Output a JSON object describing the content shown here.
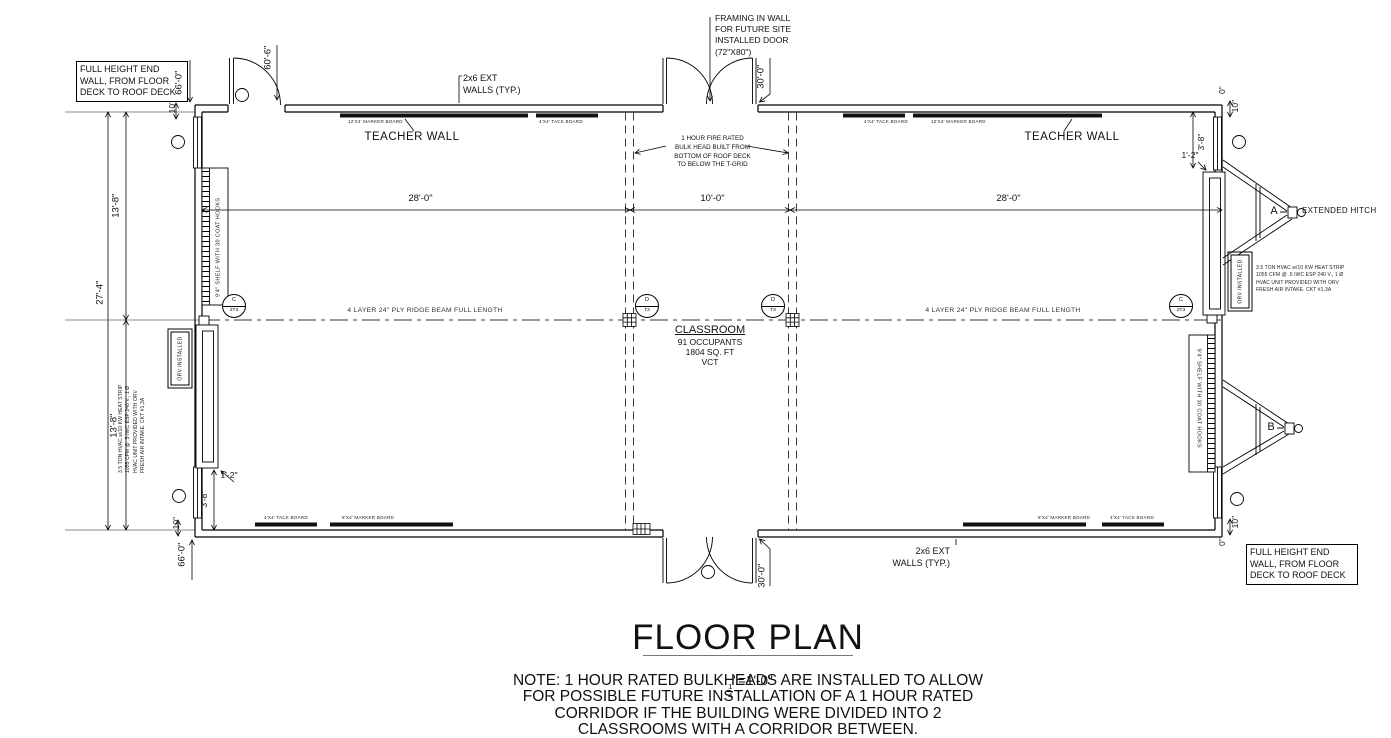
{
  "drawing": {
    "notes": {
      "end_wall": "FULL HEIGHT END\nWALL, FROM FLOOR\nDECK TO ROOF DECK",
      "framing": "FRAMING IN WALL\nFOR FUTURE SITE\nINSTALLED DOOR\n(72\"X80\")",
      "ext_walls": "2x6 EXT\nWALLS (TYP.)",
      "teacher_wall": "TEACHER WALL",
      "fire_bulkhead": "1 HOUR FIRE RATED\nBULK HEAD BUILT FROM\nBOTTOM OF ROOF DECK\nTO BELOW THE T-GRID",
      "ridge_beam": "4 LAYER 24\" PLY RIDGE BEAM FULL LENGTH",
      "hvac": "3.5 TON HVAC w/10 KW HEAT STRIP\n1055 CFM @ .5 IWC ESP 240 V., 1 Ø\nHVAC UNIT PROVIDED WITH ORV\nFRESH AIR INTAKE. CKT #1,3A",
      "orv": "ORV  INSTALLED",
      "shelf": "9'4\" SHELF WITH 30 COAT HOOKS",
      "extended_hitch": "EXTENDED HITCH"
    },
    "room": {
      "name": "CLASSROOM",
      "occupants": "91 OCCUPANTS",
      "area": "1804 SQ. FT",
      "flooring": "VCT"
    },
    "boards": {
      "marker_12": "12'X4' MARKER BOARD",
      "marker_8": "8'X4' MARKER BOARD",
      "tack_4": "4'X4' TACK BOARD"
    },
    "dims": {
      "d28": "28'-0\"",
      "d10ft": "10'-0\"",
      "d27_4": "27'-4\"",
      "d13_8": "13'-8\"",
      "d66": "66'-0\"",
      "d60_6": "60'-6\"",
      "d30": "30'-0\"",
      "d10in": "10\"",
      "d3_8": "3'-8\"",
      "d1_2": "1'-2\"",
      "d0": "0\""
    },
    "tags": {
      "hitch_a": "A",
      "hitch_b": "B",
      "c_top": "C",
      "c_bot": "2T3",
      "d_top": "D",
      "d_bot": "T3"
    }
  },
  "title_block": {
    "title": "FLOOR PLAN",
    "scale_num": "1",
    "scale_den": "4",
    "scale_rest": "\"=1'-0\"",
    "note": "NOTE: 1 HOUR RATED BULKHEADS ARE INSTALLED TO ALLOW\nFOR POSSIBLE FUTURE INSTALLATION OF A 1 HOUR RATED\nCORRIDOR IF THE BUILDING WERE DIVIDED INTO 2\nCLASSROOMS WITH A CORRIDOR BETWEEN."
  }
}
